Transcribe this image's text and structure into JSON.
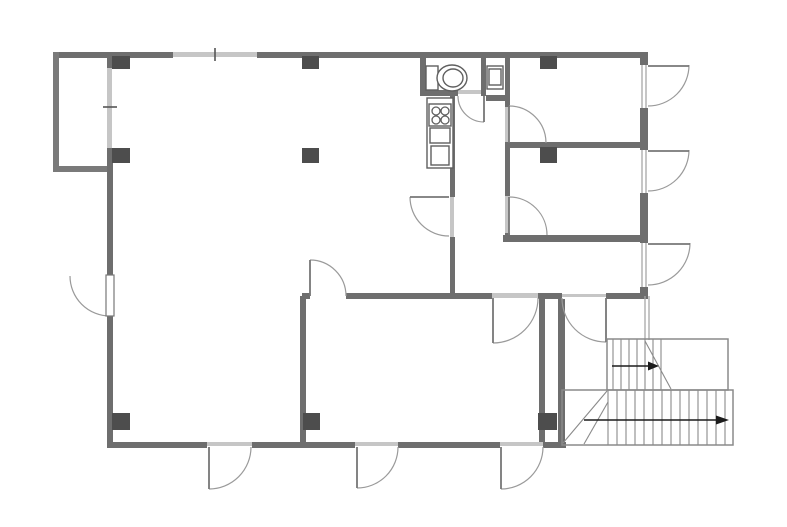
{
  "meta": {
    "kind": "architectural-floor-plan",
    "width": 787,
    "height": 527
  },
  "palette": {
    "background": "#ffffff",
    "wall": "#6e6e6e",
    "bay_wall": "#7a7a7a",
    "column": "#4d4d4d",
    "light_band": "#c6c6c6",
    "window_line": "#a8a8a8",
    "tick": "#555555",
    "door_arc": "#9a9a9a",
    "door_leaf": "#777777",
    "fixture": "#5f5f5f",
    "stair_line": "#8a8a8a",
    "arrow": "#1c1c1c"
  },
  "floorplan": {
    "walls": [
      {
        "name": "exterior-wall-top-left",
        "x": 53,
        "y": 52,
        "w": 120,
        "h": 6
      },
      {
        "name": "exterior-wall-top-right",
        "x": 257,
        "y": 52,
        "w": 391,
        "h": 6
      },
      {
        "name": "bay-wall-left",
        "x": 53,
        "y": 52,
        "w": 6,
        "h": 120
      },
      {
        "name": "bay-wall-bottom",
        "x": 53,
        "y": 166,
        "w": 57,
        "h": 6
      },
      {
        "name": "exterior-wall-left-upper",
        "x": 107,
        "y": 52,
        "w": 6,
        "h": 16
      },
      {
        "name": "exterior-wall-left-middle",
        "x": 107,
        "y": 148,
        "w": 6,
        "h": 127
      },
      {
        "name": "exterior-wall-left-lower",
        "x": 107,
        "y": 316,
        "w": 6,
        "h": 126
      },
      {
        "name": "exterior-wall-bottom-1",
        "x": 107,
        "y": 442,
        "w": 100,
        "h": 6
      },
      {
        "name": "exterior-wall-bottom-2",
        "x": 252,
        "y": 442,
        "w": 103,
        "h": 6
      },
      {
        "name": "exterior-wall-bottom-3",
        "x": 398,
        "y": 442,
        "w": 102,
        "h": 6
      },
      {
        "name": "exterior-wall-bottom-4",
        "x": 543,
        "y": 442,
        "w": 23,
        "h": 6
      },
      {
        "name": "exterior-wall-right-1",
        "x": 640,
        "y": 52,
        "w": 8,
        "h": 13
      },
      {
        "name": "exterior-wall-right-2",
        "x": 640,
        "y": 108,
        "w": 8,
        "h": 42
      },
      {
        "name": "exterior-wall-right-3",
        "x": 640,
        "y": 193,
        "w": 8,
        "h": 50
      },
      {
        "name": "exterior-wall-right-4",
        "x": 640,
        "y": 287,
        "w": 8,
        "h": 9
      },
      {
        "name": "corridor-west-wall-upper",
        "x": 450,
        "y": 96,
        "w": 5,
        "h": 101
      },
      {
        "name": "corridor-west-wall-lower",
        "x": 450,
        "y": 237,
        "w": 5,
        "h": 59
      },
      {
        "name": "corridor-east-wall-upper",
        "x": 505,
        "y": 58,
        "w": 5,
        "h": 49
      },
      {
        "name": "corridor-east-wall-middle",
        "x": 505,
        "y": 143,
        "w": 5,
        "h": 53
      },
      {
        "name": "corridor-east-wall-lower",
        "x": 505,
        "y": 233,
        "w": 5,
        "h": 9
      },
      {
        "name": "right-rooms-divider-wall",
        "x": 505,
        "y": 142,
        "w": 143,
        "h": 6
      },
      {
        "name": "lower-right-room-bottom-wall",
        "x": 503,
        "y": 235,
        "w": 145,
        "h": 7
      },
      {
        "name": "middle-wall-seg-1",
        "x": 302,
        "y": 293,
        "w": 8,
        "h": 6
      },
      {
        "name": "middle-wall-seg-2",
        "x": 346,
        "y": 293,
        "w": 146,
        "h": 6
      },
      {
        "name": "middle-wall-seg-3",
        "x": 538,
        "y": 293,
        "w": 24,
        "h": 6
      },
      {
        "name": "middle-wall-seg-4",
        "x": 606,
        "y": 293,
        "w": 42,
        "h": 6
      },
      {
        "name": "bottom-middle-room-left-wall",
        "x": 300,
        "y": 296,
        "w": 6,
        "h": 146
      },
      {
        "name": "bottom-middle-room-right-wall",
        "x": 539,
        "y": 299,
        "w": 6,
        "h": 143
      },
      {
        "name": "hall-west-wall",
        "x": 558,
        "y": 299,
        "w": 7,
        "h": 143
      },
      {
        "name": "toilet-room-left-wall",
        "x": 420,
        "y": 58,
        "w": 6,
        "h": 38
      },
      {
        "name": "toilet-room-bottom-wall",
        "x": 420,
        "y": 90,
        "w": 38,
        "h": 6
      },
      {
        "name": "toilet-partition-wall",
        "x": 481,
        "y": 58,
        "w": 5,
        "h": 38
      },
      {
        "name": "toilet-stub-wall",
        "x": 486,
        "y": 95,
        "w": 24,
        "h": 6
      }
    ],
    "light_bands": [
      {
        "name": "top-window-band",
        "x": 173,
        "y": 52,
        "w": 84,
        "h": 5
      },
      {
        "name": "left-window-band",
        "x": 107,
        "y": 68,
        "w": 5,
        "h": 80
      },
      {
        "name": "door-header-bm-right",
        "x": 492,
        "y": 293,
        "w": 46,
        "h": 5
      },
      {
        "name": "door-header-hall",
        "x": 562,
        "y": 294,
        "w": 44,
        "h": 3
      },
      {
        "name": "door-header-bottom-a",
        "x": 207,
        "y": 442,
        "w": 45,
        "h": 4
      },
      {
        "name": "door-header-bottom-b",
        "x": 355,
        "y": 442,
        "w": 43,
        "h": 4
      },
      {
        "name": "door-header-bottom-c",
        "x": 500,
        "y": 442,
        "w": 43,
        "h": 4
      },
      {
        "name": "door-header-corridor",
        "x": 450,
        "y": 197,
        "w": 4,
        "h": 40
      },
      {
        "name": "door-header-upper-right",
        "x": 505,
        "y": 107,
        "w": 4,
        "h": 36
      },
      {
        "name": "door-header-lower-right",
        "x": 505,
        "y": 196,
        "w": 4,
        "h": 37
      },
      {
        "name": "door-header-toilet",
        "x": 458,
        "y": 90,
        "w": 23,
        "h": 4
      }
    ],
    "window_lines": [
      {
        "name": "right-opening-1-line",
        "x1": 642,
        "y1": 65,
        "x2": 642,
        "y2": 108
      },
      {
        "name": "right-opening-1-line",
        "x1": 646,
        "y1": 65,
        "x2": 646,
        "y2": 108
      },
      {
        "name": "right-opening-2-line",
        "x1": 642,
        "y1": 150,
        "x2": 642,
        "y2": 193
      },
      {
        "name": "right-opening-2-line",
        "x1": 646,
        "y1": 150,
        "x2": 646,
        "y2": 193
      },
      {
        "name": "right-opening-3-line",
        "x1": 642,
        "y1": 243,
        "x2": 642,
        "y2": 287
      },
      {
        "name": "right-opening-3-line",
        "x1": 646,
        "y1": 243,
        "x2": 646,
        "y2": 287
      },
      {
        "name": "hall-thin-wall-line",
        "x1": 645,
        "y1": 296,
        "x2": 645,
        "y2": 340
      },
      {
        "name": "hall-thin-wall-line",
        "x1": 649,
        "y1": 296,
        "x2": 649,
        "y2": 340
      }
    ],
    "ticks": [
      {
        "name": "top-window-tick",
        "x1": 215,
        "y1": 48,
        "x2": 215,
        "y2": 61
      },
      {
        "name": "left-window-tick",
        "x1": 103,
        "y1": 107,
        "x2": 117,
        "y2": 107
      }
    ],
    "columns": [
      {
        "x": 112,
        "y": 56,
        "w": 18,
        "h": 13
      },
      {
        "x": 302,
        "y": 56,
        "w": 17,
        "h": 13
      },
      {
        "x": 540,
        "y": 56,
        "w": 17,
        "h": 13
      },
      {
        "x": 112,
        "y": 148,
        "w": 18,
        "h": 15
      },
      {
        "x": 302,
        "y": 148,
        "w": 17,
        "h": 15
      },
      {
        "x": 540,
        "y": 147,
        "w": 17,
        "h": 16
      },
      {
        "x": 112,
        "y": 413,
        "w": 18,
        "h": 17
      },
      {
        "x": 303,
        "y": 413,
        "w": 17,
        "h": 17
      },
      {
        "x": 538,
        "y": 413,
        "w": 19,
        "h": 17
      }
    ],
    "doors": [
      {
        "name": "toilet-door",
        "leaf": {
          "x1": 484,
          "y1": 96,
          "x2": 484,
          "y2": 122
        },
        "arc": {
          "cx": 484,
          "cy": 96,
          "r": 26,
          "a1": 90,
          "a2": 180
        }
      },
      {
        "name": "corridor-door",
        "leaf": {
          "x1": 449,
          "y1": 197,
          "x2": 410,
          "y2": 197
        },
        "arc": {
          "cx": 449,
          "cy": 197,
          "r": 39,
          "a1": 90,
          "a2": 180
        }
      },
      {
        "name": "upper-right-room-door",
        "leaf": {
          "x1": 509,
          "y1": 143,
          "x2": 509,
          "y2": 106
        },
        "arc": {
          "cx": 509,
          "cy": 143,
          "r": 37,
          "a1": 270,
          "a2": 360
        }
      },
      {
        "name": "lower-right-room-door",
        "leaf": {
          "x1": 509,
          "y1": 235,
          "x2": 509,
          "y2": 197
        },
        "arc": {
          "cx": 509,
          "cy": 235,
          "r": 38,
          "a1": 270,
          "a2": 360
        }
      },
      {
        "name": "bottom-middle-room-north-door",
        "leaf": {
          "x1": 310,
          "y1": 296,
          "x2": 310,
          "y2": 260
        },
        "arc": {
          "cx": 310,
          "cy": 296,
          "r": 36,
          "a1": 270,
          "a2": 360
        }
      },
      {
        "name": "bottom-middle-room-east-door",
        "leaf": {
          "x1": 493,
          "y1": 298,
          "x2": 493,
          "y2": 343
        },
        "arc": {
          "cx": 493,
          "cy": 298,
          "r": 45,
          "a1": 0,
          "a2": 90
        }
      },
      {
        "name": "hall-door",
        "leaf": {
          "x1": 606,
          "y1": 298,
          "x2": 606,
          "y2": 342
        },
        "arc": {
          "cx": 606,
          "cy": 298,
          "r": 44,
          "a1": 90,
          "a2": 180
        }
      },
      {
        "name": "left-exterior-door",
        "leafRect": {
          "x": 106,
          "y": 275,
          "w": 8,
          "h": 41
        },
        "arc": {
          "cx": 110,
          "cy": 276,
          "r": 40,
          "a1": 90,
          "a2": 180
        }
      },
      {
        "name": "bottom-exterior-door-a",
        "leaf": {
          "x1": 209,
          "y1": 447,
          "x2": 209,
          "y2": 489
        },
        "arc": {
          "cx": 209,
          "cy": 447,
          "r": 42,
          "a1": 0,
          "a2": 90
        }
      },
      {
        "name": "bottom-exterior-door-b",
        "leaf": {
          "x1": 357,
          "y1": 447,
          "x2": 357,
          "y2": 488
        },
        "arc": {
          "cx": 357,
          "cy": 447,
          "r": 41,
          "a1": 0,
          "a2": 90
        }
      },
      {
        "name": "bottom-exterior-door-c",
        "leaf": {
          "x1": 501,
          "y1": 447,
          "x2": 501,
          "y2": 489
        },
        "arc": {
          "cx": 501,
          "cy": 447,
          "r": 42,
          "a1": 0,
          "a2": 90
        }
      },
      {
        "name": "right-exterior-door-1",
        "leaf": {
          "x1": 648,
          "y1": 66,
          "x2": 689,
          "y2": 66
        },
        "arc": {
          "cx": 648,
          "cy": 65,
          "r": 41,
          "a1": 0,
          "a2": 90
        }
      },
      {
        "name": "right-exterior-door-2",
        "leaf": {
          "x1": 648,
          "y1": 151,
          "x2": 689,
          "y2": 151
        },
        "arc": {
          "cx": 648,
          "cy": 150,
          "r": 41,
          "a1": 0,
          "a2": 90
        }
      },
      {
        "name": "right-exterior-door-3",
        "leaf": {
          "x1": 648,
          "y1": 244,
          "x2": 690,
          "y2": 244
        },
        "arc": {
          "cx": 648,
          "cy": 243,
          "r": 42,
          "a1": 0,
          "a2": 90
        }
      }
    ],
    "fixtures": {
      "rects": [
        {
          "name": "toilet-tank",
          "x": 426,
          "y": 66,
          "w": 12,
          "h": 24
        },
        {
          "name": "hand-sink-outer",
          "x": 487,
          "y": 66,
          "w": 16,
          "h": 23
        },
        {
          "name": "hand-sink-inner",
          "x": 489,
          "y": 69,
          "w": 12,
          "h": 16
        },
        {
          "name": "kitchen-counter",
          "x": 427,
          "y": 98,
          "w": 26,
          "h": 70
        },
        {
          "name": "kitchen-stove",
          "x": 429,
          "y": 104,
          "w": 22,
          "h": 22
        },
        {
          "name": "kitchen-sink",
          "x": 430,
          "y": 128,
          "w": 20,
          "h": 15
        },
        {
          "name": "kitchen-cabinet",
          "x": 431,
          "y": 146,
          "w": 18,
          "h": 19
        }
      ],
      "ellipses": [
        {
          "name": "toilet-bowl",
          "cx": 452,
          "cy": 78,
          "rx": 15,
          "ry": 13
        },
        {
          "name": "toilet-bowl-inner",
          "cx": 453,
          "cy": 78,
          "rx": 10,
          "ry": 9
        }
      ],
      "circles": [
        {
          "name": "stove-burner",
          "cx": 436,
          "cy": 111,
          "r": 4
        },
        {
          "name": "stove-burner",
          "cx": 445,
          "cy": 111,
          "r": 4
        },
        {
          "name": "stove-burner",
          "cx": 436,
          "cy": 120,
          "r": 4
        },
        {
          "name": "stove-burner",
          "cx": 445,
          "cy": 120,
          "r": 4
        }
      ]
    },
    "stairs": {
      "upper_rect": {
        "x": 607,
        "y": 339,
        "w": 121,
        "h": 51
      },
      "lower_rect": {
        "x": 562,
        "y": 390,
        "w": 171,
        "h": 55
      },
      "upper_treads_x": [
        613,
        621,
        629,
        637,
        645,
        653,
        661
      ],
      "upper_treads_y": [
        339,
        390
      ],
      "lower_treads_x": [
        608,
        617,
        626,
        635,
        644,
        653,
        662,
        671,
        680,
        689,
        698,
        707,
        716,
        725
      ],
      "lower_treads_y": [
        390,
        445
      ],
      "diagonals": [
        {
          "name": "stair-break-line",
          "x1": 645,
          "y1": 341,
          "x2": 671,
          "y2": 389
        },
        {
          "name": "stair-winder-line",
          "x1": 563,
          "y1": 443,
          "x2": 607,
          "y2": 391
        },
        {
          "name": "stair-winder-line",
          "x1": 584,
          "y1": 444,
          "x2": 608,
          "y2": 402
        }
      ],
      "arrows": [
        {
          "name": "stair-direction-arrow-upper",
          "x1": 612,
          "y1": 366,
          "x2": 648,
          "y2": 366,
          "tip": [
            659,
            366
          ],
          "head": [
            [
              648,
              361.5
            ],
            [
              659,
              366
            ],
            [
              648,
              370.5
            ]
          ]
        },
        {
          "name": "stair-direction-arrow-lower",
          "x1": 584,
          "y1": 420,
          "x2": 716,
          "y2": 420,
          "tip": [
            729,
            420
          ],
          "head": [
            [
              716,
              415.5
            ],
            [
              729,
              420
            ],
            [
              716,
              424.5
            ]
          ]
        }
      ]
    }
  }
}
